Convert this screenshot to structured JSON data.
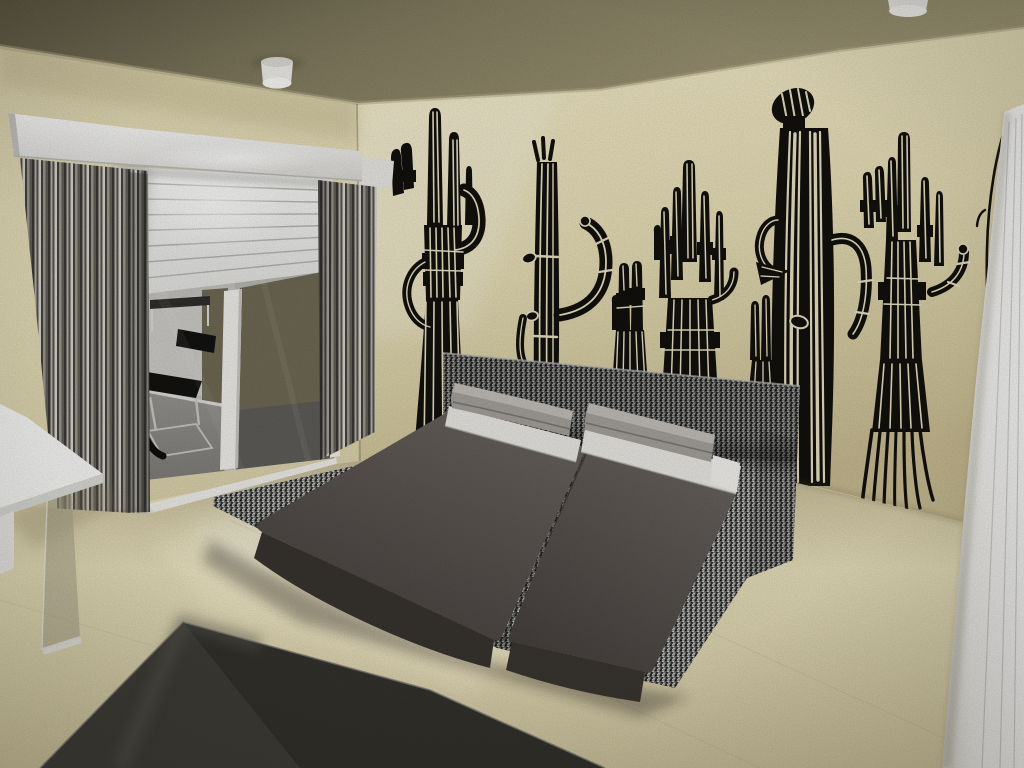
{
  "meta": {
    "type": "3d-interior-render",
    "subject": "Modern bedroom 3D rendering with black saguaro cactus wall decals, low tweed platform bed, sliding glass door and white wardrobe",
    "view": "wide-angle corner view"
  },
  "palette": {
    "ceiling_dark": "#5f5a44",
    "ceiling": "#847d61",
    "ceiling_light": "#a49c7a",
    "wall": "#e9e0ba",
    "wall_bright": "#f4ecc9",
    "wall_shadow": "#c7bb91",
    "floor": "#cdc39d",
    "floor_bright": "#e9e1bc",
    "floor_front": "#d2c8a1",
    "rug": "#44423c",
    "rug_dark": "#2f2e2a",
    "rug_light": "#56544c",
    "rug_edge": "#7b7970",
    "decal": "#12100d",
    "decal_gap": "#e8e1c2",
    "pelmet": "#fafaf8",
    "blind": "#f4f4f2",
    "blind_line": "#b5b5b3",
    "curtain_dark": "#3b3935",
    "curtain_mid": "#8b8882",
    "curtain_light": "#d8d5ce",
    "glass_pane": "#c4c3bf",
    "glass_panel": "#cdccc9",
    "glass_olive": "#6e6a54",
    "glass_floor": "#8e8c88",
    "glass_floor_dark": "#63625e",
    "frame": "#f0efeb",
    "baseboard": "#dedcd8",
    "chair": "#121210",
    "chair_frame": "#cbc9c5",
    "tweed_base": "#6c6c6a",
    "duvet": "#5f5955",
    "duvet_deep": "#45403d",
    "duvet_front": "#38342f",
    "pillow": "#a5a19c",
    "pillow_top": "#c3bfba",
    "sheet": "#eae9e5",
    "wardrobe": "#f5f4f1",
    "table_top": "#f7f7f5",
    "table_edge": "#dadad6",
    "leg_glass": "rgba(168,162,138,0.55)",
    "light_body": "#eeede9",
    "light_bottom": "#fbfaf8",
    "shadow": "#1c1914"
  },
  "scene": {
    "ceiling": {
      "label": "ceiling",
      "lights": 2,
      "light_style": "round surface-mounted cylinder spots"
    },
    "walls": {
      "back": "window wall with pelmet, half-lowered white venetian blind, sliding glass door and two grey striped curtains",
      "right": "cream wall covered with black saguaro cactus decals"
    },
    "decals": {
      "motif": "saguaro cactus",
      "color": "black stencil with rib stripes",
      "count": 7
    },
    "adjacent_room": {
      "seen_through": "sliding glass door",
      "furniture": [
        "black cantilever chair",
        "small white table with dark top"
      ]
    },
    "bed": {
      "type": "low platform bed",
      "platform_fabric": "black and white tweed",
      "mattresses": 2,
      "pillows": 2,
      "bedding": "dark grey duvets with white sheet bands"
    },
    "rug": {
      "color": "dark grey",
      "position": "foreground"
    },
    "side_table": {
      "top": "white lacquer",
      "leg": "smoked glass panel",
      "position": "left foreground"
    },
    "wardrobe": {
      "color": "white panels",
      "position": "right edge"
    },
    "floor": {
      "finish": "beige stone tiles with light pool from window"
    }
  }
}
